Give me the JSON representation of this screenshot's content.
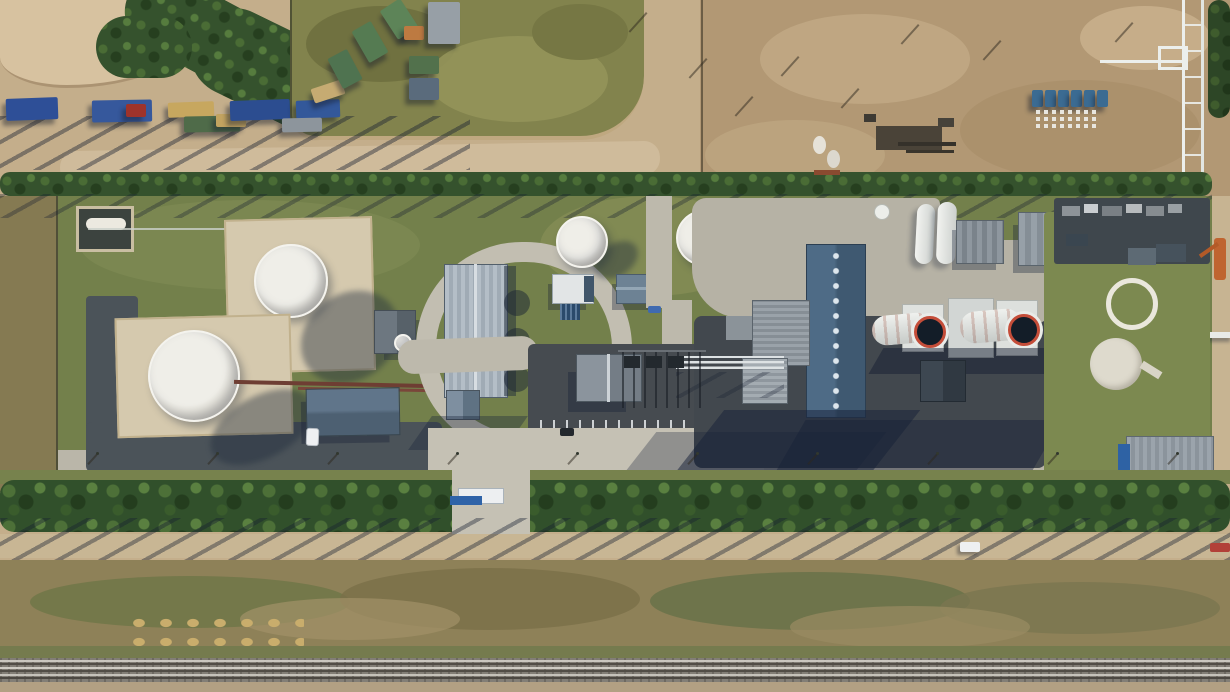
{
  "scene": {
    "type": "aerial-photograph",
    "description": "Top-down drone view of a combined-cycle power plant with tank farm, truck parking, dirt laydown yard, tree windbreaks and a railway line",
    "lighting": "low sun from upper area, long hard shadows cast toward lower-left",
    "regions": {
      "top_left": "gravel yard with parked truck trailers and a dark tree cluster",
      "top_center": "olive grass field ringed by dirt roads",
      "top_right": "brown dirt laydown yard with equipment, white cones and blue containers",
      "middle_left": "two large white storage tanks inside beige containment bunds, dark asphalt perimeter roads",
      "middle_center": "warehouse with ribbed roof inside an oval loop road, two smaller white tanks, gate house with blue sign",
      "middle_right": "turbine hall with vented ridge, twin white exhaust stacks with red-striped rims, grey auxiliary buildings, white pipe racks",
      "far_right": "green field with white ring foundation, circular concrete pad, orange crane, blue-walled warehouse",
      "bottom": "tree windbreak row, dirt access road, mottled scrub strip, railway tracks"
    },
    "palette": {
      "dirt_light": "#c4ae8b",
      "dirt_pale": "#d7c2a0",
      "dirt_brown": "#b29874",
      "grass_field": "#82834d",
      "grass_facility": "#73804b",
      "tree_dark": "#31502b",
      "concrete_road": "#c2beb1",
      "asphalt": "#4b5359",
      "bund_beige": "#d5c9ae",
      "tank_white": "#efeee8",
      "roof_slate_blue": "#4e6b86",
      "roof_ribbed_grey": "#b4bec7",
      "stack_mouth_dark": "#131d28",
      "stack_rim_red": "#c44d39",
      "pipe_white": "#e9ebe8",
      "pipe_teal": "#7da895",
      "container_blue": "#3b6b92",
      "crane_orange": "#bf6430",
      "gate_sign_blue": "#2f63a8",
      "rail_ballast": "#827e76",
      "hay_gold": "#c9ad6c"
    },
    "objects": {
      "trucks": [
        {
          "x": 6,
          "y": 98,
          "w": 52,
          "h": 22,
          "color": "#2e4f97",
          "rot": -2
        },
        {
          "x": 92,
          "y": 100,
          "w": 60,
          "h": 22,
          "color": "#36589c",
          "rot": -1
        },
        {
          "x": 126,
          "y": 104,
          "w": 20,
          "h": 13,
          "color": "#9e332b",
          "rot": 0
        },
        {
          "x": 168,
          "y": 102,
          "w": 46,
          "h": 15,
          "color": "#c7a75f",
          "rot": -2
        },
        {
          "x": 184,
          "y": 116,
          "w": 56,
          "h": 16,
          "color": "#4f6b49",
          "rot": -1
        },
        {
          "x": 216,
          "y": 114,
          "w": 30,
          "h": 13,
          "color": "#c2a360",
          "rot": 0
        },
        {
          "x": 230,
          "y": 100,
          "w": 60,
          "h": 20,
          "color": "#2c4d90",
          "rot": -2
        },
        {
          "x": 296,
          "y": 100,
          "w": 44,
          "h": 18,
          "color": "#33589a",
          "rot": -2
        },
        {
          "x": 282,
          "y": 118,
          "w": 40,
          "h": 14,
          "color": "#8d959c",
          "rot": -1
        },
        {
          "x": 312,
          "y": 84,
          "w": 32,
          "h": 15,
          "color": "#c6ab72",
          "rot": -18
        },
        {
          "x": 334,
          "y": 52,
          "w": 22,
          "h": 34,
          "color": "#4f7350",
          "rot": -28
        },
        {
          "x": 359,
          "y": 24,
          "w": 22,
          "h": 36,
          "color": "#557b52",
          "rot": -30
        },
        {
          "x": 387,
          "y": 2,
          "w": 24,
          "h": 34,
          "color": "#5d8458",
          "rot": -33
        },
        {
          "x": 404,
          "y": 26,
          "w": 20,
          "h": 14,
          "color": "#bd7a41",
          "rot": 0
        },
        {
          "x": 428,
          "y": 2,
          "w": 32,
          "h": 42,
          "color": "#979fa6",
          "rot": 0
        },
        {
          "x": 409,
          "y": 56,
          "w": 30,
          "h": 18,
          "color": "#52714c",
          "rot": 0
        },
        {
          "x": 409,
          "y": 78,
          "w": 30,
          "h": 22,
          "color": "#5a6b7c",
          "rot": 0
        }
      ],
      "blue_containers": [
        {
          "x": 1032,
          "y": 90,
          "w": 11,
          "h": 17
        },
        {
          "x": 1045,
          "y": 90,
          "w": 11,
          "h": 17
        },
        {
          "x": 1058,
          "y": 90,
          "w": 11,
          "h": 17
        },
        {
          "x": 1071,
          "y": 90,
          "w": 11,
          "h": 17
        },
        {
          "x": 1084,
          "y": 90,
          "w": 11,
          "h": 17
        },
        {
          "x": 1097,
          "y": 90,
          "w": 11,
          "h": 17
        }
      ],
      "yard_items": [
        {
          "x": 813,
          "y": 136,
          "w": 13,
          "h": 18,
          "color": "#e6e2d8",
          "round": true
        },
        {
          "x": 827,
          "y": 150,
          "w": 13,
          "h": 18,
          "color": "#dcd8ce",
          "round": true
        },
        {
          "x": 876,
          "y": 126,
          "w": 66,
          "h": 24,
          "color": "#4a4338"
        },
        {
          "x": 898,
          "y": 142,
          "w": 58,
          "h": 4,
          "color": "#35312a"
        },
        {
          "x": 906,
          "y": 150,
          "w": 48,
          "h": 3,
          "color": "#3a352c"
        },
        {
          "x": 814,
          "y": 170,
          "w": 26,
          "h": 5,
          "color": "#8a4a30"
        },
        {
          "x": 864,
          "y": 114,
          "w": 12,
          "h": 8,
          "color": "#3e3a33"
        },
        {
          "x": 938,
          "y": 118,
          "w": 16,
          "h": 9,
          "color": "#46423a"
        }
      ],
      "pad_items": [
        {
          "x": 1062,
          "y": 206,
          "w": 18,
          "h": 10,
          "color": "#8d9398"
        },
        {
          "x": 1084,
          "y": 204,
          "w": 14,
          "h": 9,
          "color": "#c9cdd0"
        },
        {
          "x": 1102,
          "y": 206,
          "w": 20,
          "h": 10,
          "color": "#7a8085"
        },
        {
          "x": 1126,
          "y": 204,
          "w": 16,
          "h": 9,
          "color": "#b7bbbd"
        },
        {
          "x": 1146,
          "y": 206,
          "w": 18,
          "h": 10,
          "color": "#868c90"
        },
        {
          "x": 1168,
          "y": 204,
          "w": 14,
          "h": 9,
          "color": "#9aa0a4"
        },
        {
          "x": 1128,
          "y": 248,
          "w": 28,
          "h": 17,
          "color": "#5d6a74"
        },
        {
          "x": 1156,
          "y": 244,
          "w": 30,
          "h": 18,
          "color": "#46525c"
        },
        {
          "x": 1066,
          "y": 234,
          "w": 22,
          "h": 12,
          "color": "#3a4650"
        }
      ],
      "dirt_pole_shadows": [
        {
          "x": 918,
          "y": 24
        },
        {
          "x": 1132,
          "y": 22
        },
        {
          "x": 798,
          "y": 56
        },
        {
          "x": 858,
          "y": 88
        },
        {
          "x": 706,
          "y": 58
        },
        {
          "x": 646,
          "y": 12
        },
        {
          "x": 752,
          "y": 96
        },
        {
          "x": 1000,
          "y": 40
        }
      ],
      "lamp_posts": [
        {
          "x": 96,
          "y": 452
        },
        {
          "x": 216,
          "y": 452
        },
        {
          "x": 336,
          "y": 452
        },
        {
          "x": 456,
          "y": 452
        },
        {
          "x": 576,
          "y": 452
        },
        {
          "x": 696,
          "y": 452
        },
        {
          "x": 816,
          "y": 452
        },
        {
          "x": 936,
          "y": 452
        },
        {
          "x": 1056,
          "y": 452
        },
        {
          "x": 1176,
          "y": 452
        }
      ],
      "switchyard_poles": [
        {
          "x": 622,
          "y": 352
        },
        {
          "x": 633,
          "y": 352
        },
        {
          "x": 644,
          "y": 352
        },
        {
          "x": 655,
          "y": 352
        },
        {
          "x": 666,
          "y": 352
        },
        {
          "x": 677,
          "y": 352
        },
        {
          "x": 688,
          "y": 352
        },
        {
          "x": 699,
          "y": 352
        }
      ],
      "transformers": [
        {
          "x": 624,
          "y": 356,
          "w": 16,
          "h": 12
        },
        {
          "x": 646,
          "y": 356,
          "w": 16,
          "h": 12
        },
        {
          "x": 668,
          "y": 356,
          "w": 16,
          "h": 12
        }
      ],
      "rail_lines": [
        {
          "y": 660,
          "color": "#cac7bf"
        },
        {
          "y": 663,
          "color": "#514d46"
        },
        {
          "y": 667,
          "color": "#cfccc4"
        },
        {
          "y": 670,
          "color": "#514d46"
        },
        {
          "y": 674,
          "color": "#c5c2ba"
        },
        {
          "y": 677,
          "color": "#4b4741"
        }
      ],
      "vehicles": {
        "white_van_gate": {
          "x": 306,
          "y": 428
        },
        "white_car_road": {
          "x": 960,
          "y": 542
        },
        "red_car_road": {
          "x": 1210,
          "y": 543
        },
        "blue_car_center": {
          "x": 648,
          "y": 306
        },
        "dark_car_parking": {
          "x": 560,
          "y": 428
        }
      },
      "storage_tanks": {
        "large_tank_upper": {
          "cx": 291,
          "cy": 281,
          "r": 37
        },
        "large_tank_lower": {
          "cx": 194,
          "cy": 376,
          "r": 46
        },
        "small_tank_a": {
          "cx": 582,
          "cy": 242,
          "r": 26
        },
        "small_tank_b": {
          "cx": 704,
          "cy": 238,
          "r": 28
        },
        "tiny_tank": {
          "cx": 403,
          "cy": 343,
          "r": 9
        }
      },
      "stacks": {
        "count": 2,
        "mouth_color": "#131d28",
        "rim_stripe": "red-white",
        "mouth_1": {
          "cx": 930,
          "cy": 332,
          "r": 16
        },
        "mouth_2": {
          "cx": 1024,
          "cy": 330,
          "r": 16
        }
      },
      "field_features": {
        "white_ring": {
          "cx": 1132,
          "cy": 304,
          "r": 26
        },
        "concrete_pad": {
          "cx": 1116,
          "cy": 364,
          "r": 26
        }
      }
    }
  }
}
